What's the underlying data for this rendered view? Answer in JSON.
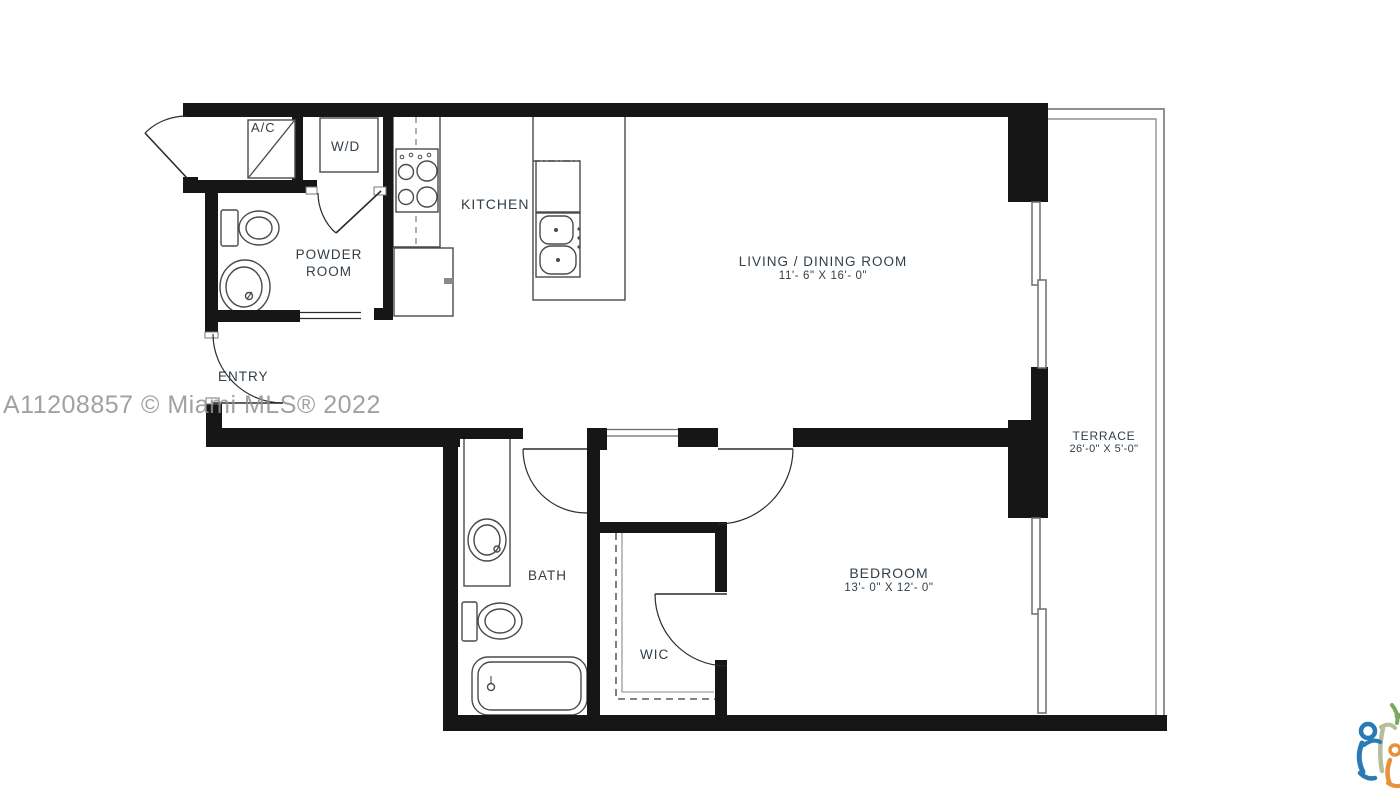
{
  "title": "Residential unit floor plan",
  "watermark": "A11208857 © Miami MLS® 2022",
  "rooms": {
    "ac": {
      "label": "A/C"
    },
    "wd": {
      "label": "W/D"
    },
    "kitchen": {
      "label": "KITCHEN"
    },
    "powder": {
      "line1": "POWDER",
      "line2": "ROOM"
    },
    "entry": {
      "label": "ENTRY"
    },
    "living": {
      "label": "LIVING / DINING ROOM",
      "dims": "11'- 6\" X 16'- 0\""
    },
    "bath": {
      "label": "BATH"
    },
    "wic": {
      "label": "WIC"
    },
    "bedroom": {
      "label": "BEDROOM",
      "dims": "13'- 0\" X 12'- 0\""
    },
    "terrace": {
      "label": "TERRACE",
      "dims": "26'-0\" X 5'-0\""
    }
  },
  "colors": {
    "wall": "#161616",
    "fixture_line": "#4a4a4a",
    "label_text": "#333e47",
    "watermark_gray": "#919191",
    "terrace_line": "#909090",
    "logo_blue": "#2a7ab5",
    "logo_orange": "#e8903a",
    "logo_green": "#7aa95c",
    "logo_sage": "#b5bd9a"
  }
}
